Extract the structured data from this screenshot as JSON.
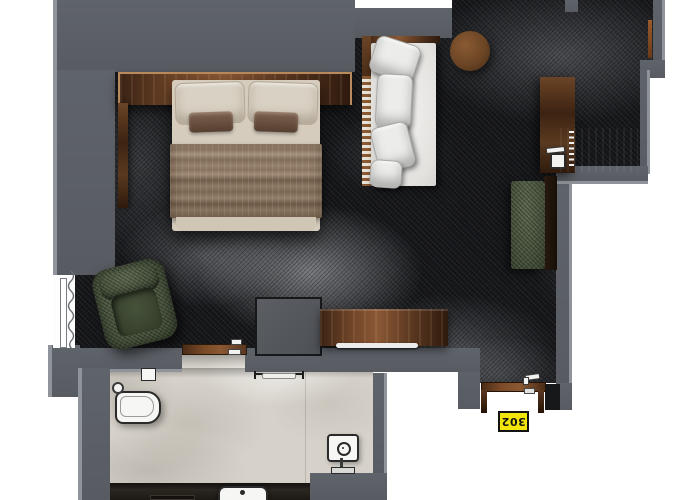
{
  "plan": {
    "title": "Hotel room floor plan",
    "room_label": "302",
    "rooms": [
      "bedroom",
      "bathroom",
      "entry"
    ]
  },
  "furniture": [
    "double-bed",
    "headboard-shelf",
    "daybed-sofa",
    "round-side-table",
    "dresser-desk",
    "desk-chair",
    "green-bench",
    "green-armchair",
    "console-sideboard",
    "storage-box",
    "toilet",
    "flush-plate",
    "sink",
    "shower-head",
    "towel-rail",
    "window-curtain",
    "bathroom-door",
    "entry-door"
  ],
  "colors": {
    "wall": "#5c6066",
    "wall_edge": "#8f949b",
    "bedroom_floor": "#17181b",
    "bathroom_tile": "#d6d2ca",
    "wood": "#7a4a2a",
    "bed_linen": "#d5ccbd",
    "blanket": "#8a7663",
    "sofa_fabric": "#e9e8e5",
    "green_velvet": "#47523c",
    "label_yellow": "#f2e50a"
  }
}
